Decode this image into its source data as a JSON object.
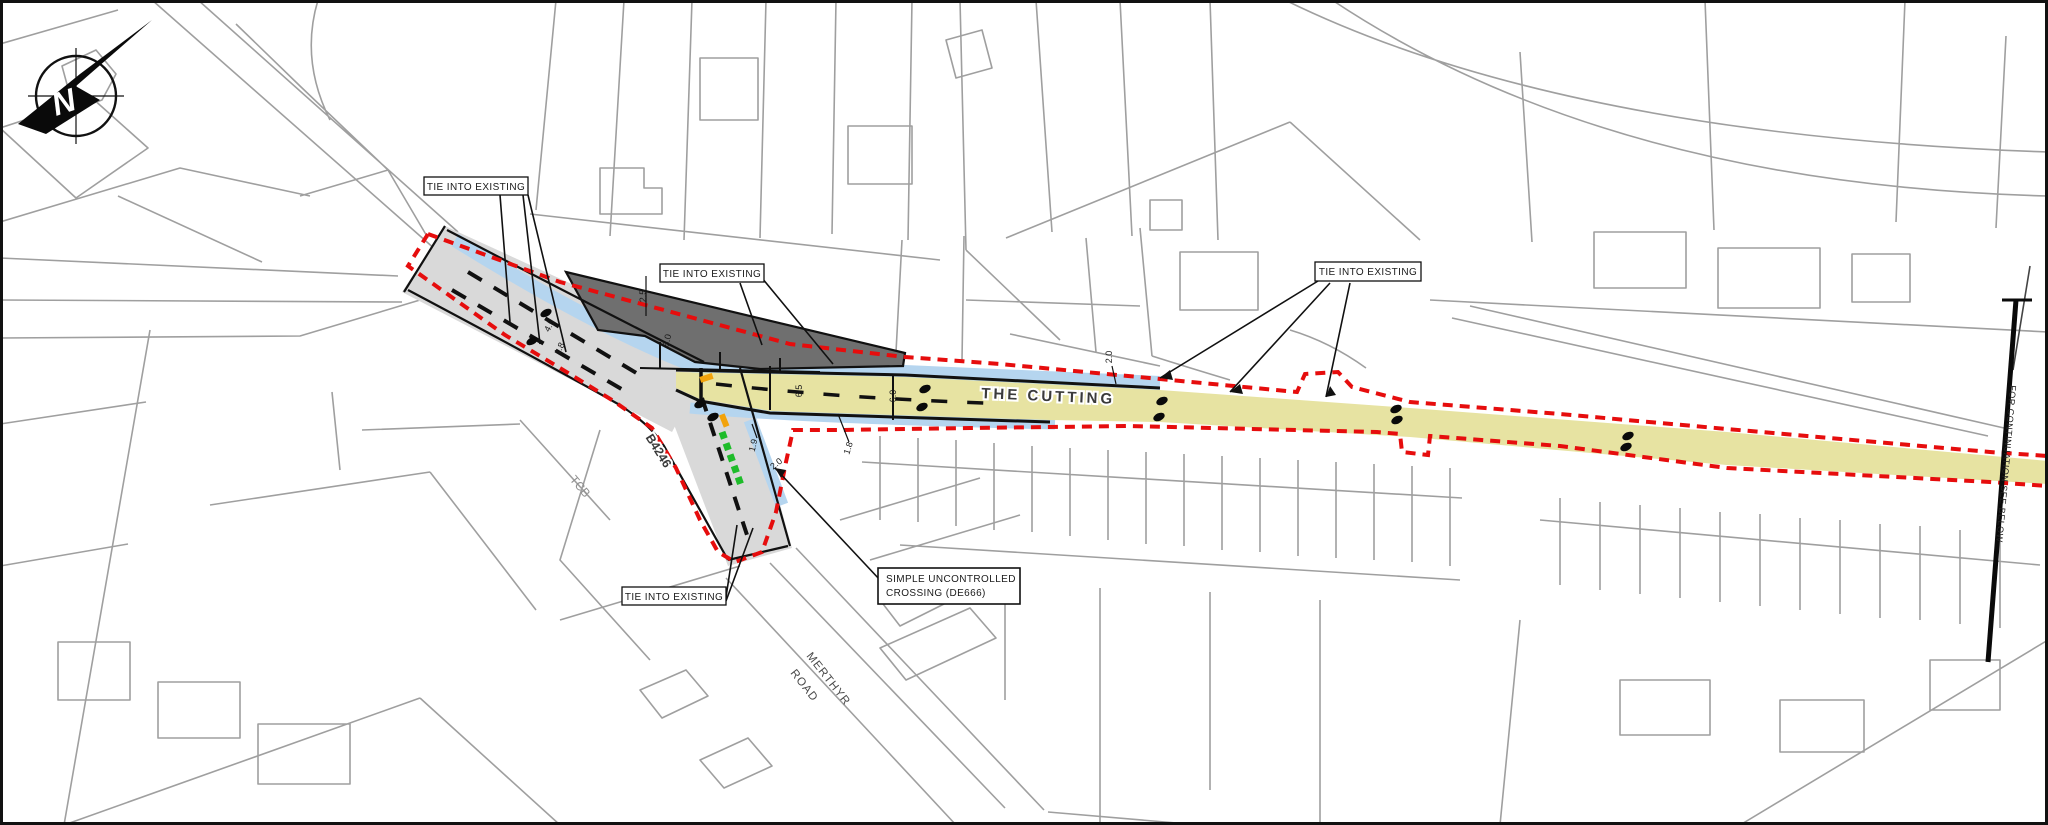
{
  "map": {
    "north_label": "N",
    "road_names": {
      "the_cutting": "THE CUTTING",
      "b4246": "B4246",
      "merthyr_line1": "MERTHYR",
      "merthyr_line2": "ROAD",
      "tcb": "TCB"
    },
    "callouts": {
      "tie": "TIE INTO EXISTING",
      "crossing1": "SIMPLE UNCONTROLLED",
      "crossing2": "CROSSING (DE666)",
      "continuation": "FOR CONTINUATION SEE BELOW"
    },
    "dimensions": [
      "2.5",
      "5.0",
      "4.5",
      "1.8",
      "6.5",
      "6.0",
      "1.9",
      "1.8",
      "2.0",
      "2.0"
    ],
    "colors": {
      "site_boundary": "#e60d0d",
      "carriageway": "#e7e3a2",
      "footway": "#b5d5ef",
      "hatched_area": "#6f6f6f",
      "existing_road": "#d9d9d9",
      "crossing_marking": "#1ebc2a",
      "tactile": "#f2a30c",
      "base_lines": "#9f9f9f",
      "frame": "#111111"
    }
  }
}
